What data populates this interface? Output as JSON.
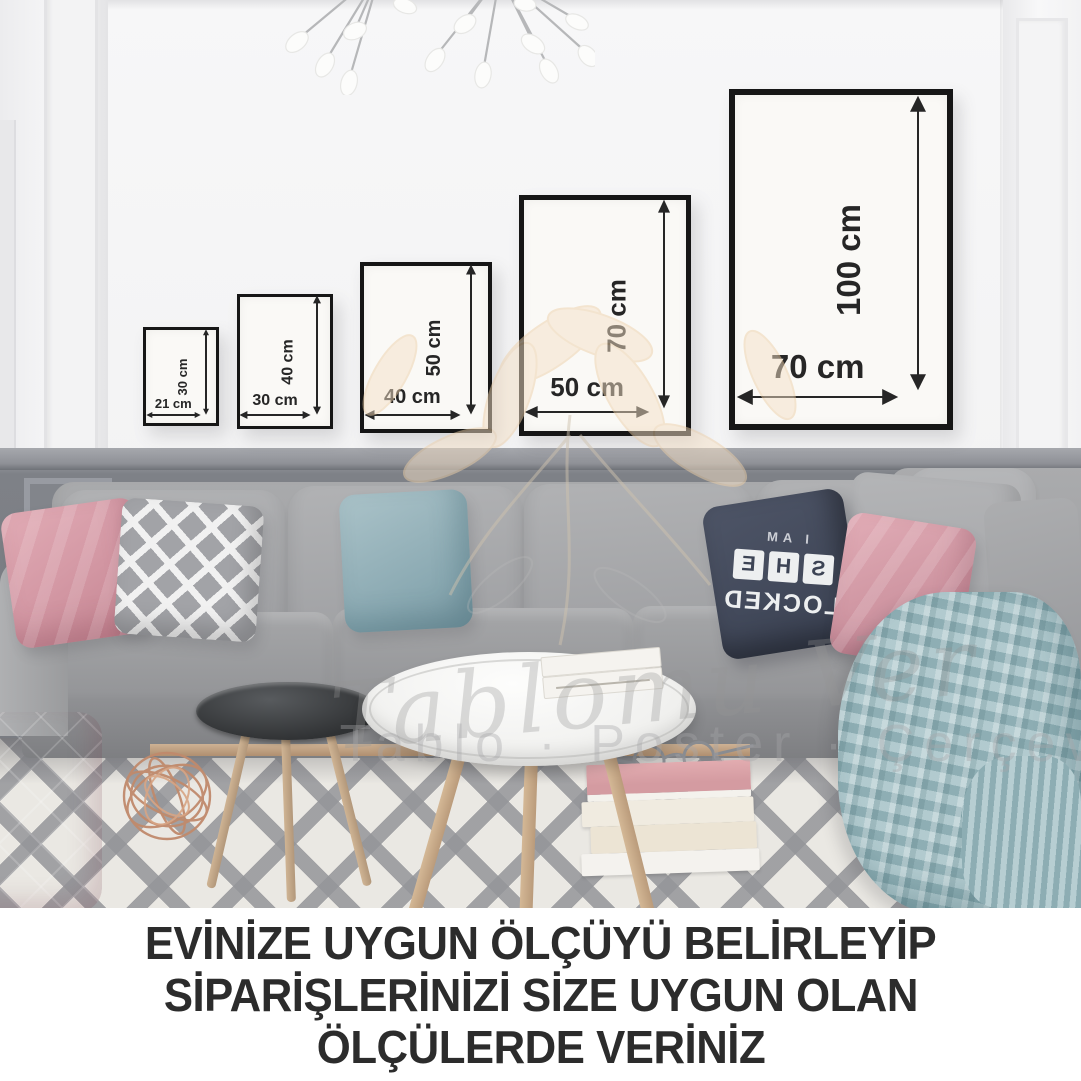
{
  "frames": [
    {
      "name": "21x30",
      "width_label": "21 cm",
      "height_label": "30 cm"
    },
    {
      "name": "30x40",
      "width_label": "30 cm",
      "height_label": "40 cm"
    },
    {
      "name": "40x50",
      "width_label": "40 cm",
      "height_label": "50 cm"
    },
    {
      "name": "50x70",
      "width_label": "50 cm",
      "height_label": "70 cm"
    },
    {
      "name": "70x100",
      "width_label": "70 cm",
      "height_label": "100 cm"
    }
  ],
  "watermark": {
    "script": "Tablomu Ver",
    "categories": "Tablo · Poster · Çerçeve"
  },
  "pillow_text": {
    "line1": "I AM",
    "tiles": [
      "S",
      "H",
      "E"
    ],
    "line3": "LOCKED"
  },
  "caption": {
    "line1": "EVİNİZE UYGUN ÖLÇÜYÜ BELİRLEYİP",
    "line2": "SİPARİŞLERİNİZİ SİZE UYGUN OLAN",
    "line3": "ÖLÇÜLERDE VERİNİZ"
  },
  "colors": {
    "frame_border": "#161616",
    "dimension_text": "#262626",
    "caption_text": "#2c2c2c",
    "wall": "#f4f4f5",
    "wainscot": "#7e8187",
    "sofa": "#9d9ea1",
    "pillow_pink": "#d59aa6",
    "pillow_teal": "#93b4bc",
    "pillow_navy": "#434a5c",
    "blanket_blue": "#a5c2c7",
    "watermark_peach": "#f5ddc2",
    "rug_stripe": "#97989c"
  }
}
